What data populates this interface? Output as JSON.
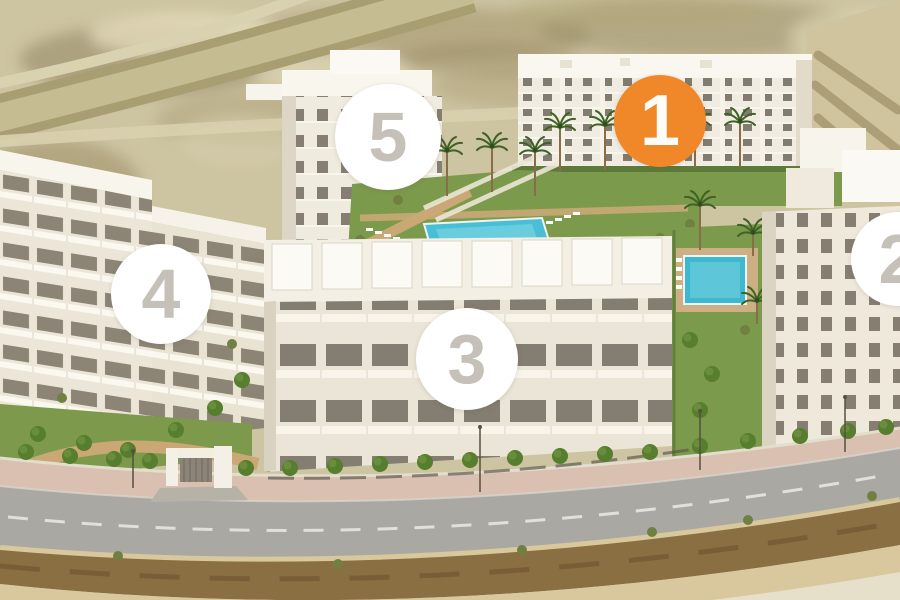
{
  "scene": {
    "description": "Aerial 3D render of a white apartment development with five numbered blocks, landscaped gardens, two turquoise pools, palm trees, perimeter wall with entrance gate, and a curving road over desert terrain",
    "colors": {
      "marker_highlight_bg": "#F0882A",
      "marker_highlight_text": "#FDFCF8",
      "marker_bg": "#FFFFFF",
      "marker_text": "#C6C1B8",
      "terrain": "#CDC4A2",
      "building_face": "#F1ECE1",
      "lawn": "#7C9A4B",
      "pool": "#49BED4",
      "road": "#A9A8A2",
      "dirt": "#8A6F43"
    }
  },
  "markers": [
    {
      "label": "1",
      "highlighted": true
    },
    {
      "label": "2",
      "highlighted": false
    },
    {
      "label": "3",
      "highlighted": false
    },
    {
      "label": "4",
      "highlighted": false
    },
    {
      "label": "5",
      "highlighted": false
    }
  ]
}
